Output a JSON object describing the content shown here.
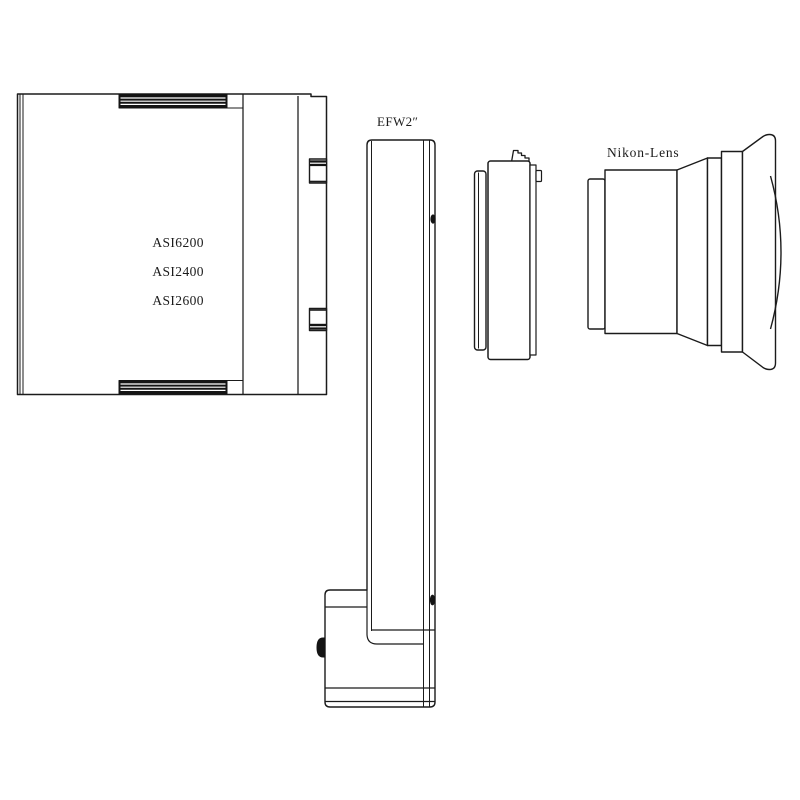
{
  "page": {
    "background": "#ffffff",
    "line_color": "#1b1b1b",
    "dark_fill": "#141414"
  },
  "camera": {
    "models": [
      "ASI6200",
      "ASI2400",
      "ASI2600"
    ]
  },
  "filter_wheel": {
    "label": "EFW2″"
  },
  "lens": {
    "label": "Nikon-Lens"
  }
}
